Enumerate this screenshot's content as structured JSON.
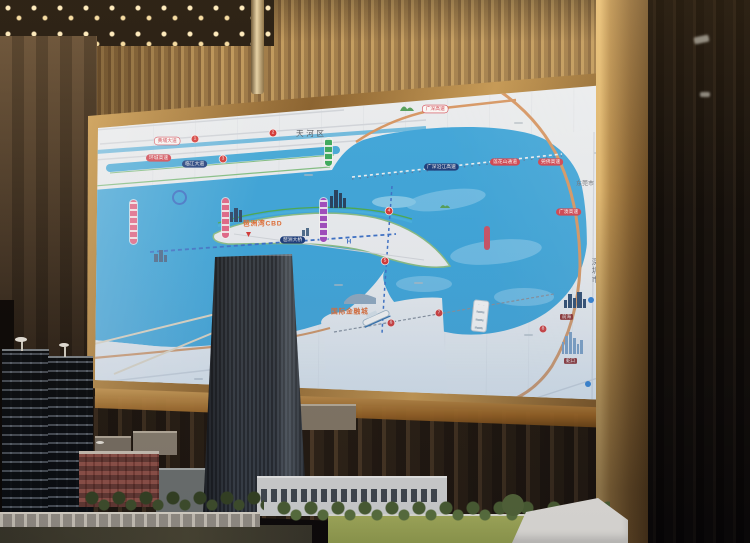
{
  "map": {
    "title_district": "天河区",
    "city_dongguan": "东莞市",
    "city_shenzhen": "深圳市",
    "cbd_label": "琶洲湾CBD",
    "financial_city_label": "国际金融城",
    "expressway_bay_pill": "广深沿江高速",
    "crossing_pill": "莲花山通道",
    "bridge_pill": "琶洲大桥",
    "road_pill_white_left": "黄埔大道",
    "road_pill_red_left": "环城高速",
    "road_pill_navy_left": "临江大道",
    "road_pill_white_top": "广深高速",
    "road_pill_red_right_1": "莞佛高速",
    "road_pill_red_right_2": "广澳高速",
    "road_pill_red_bottom": "南沙港快速",
    "sz_tag_1": "前海",
    "sz_tag_2": "蛇口",
    "hospital_marker": "H",
    "stations": [
      "1",
      "2",
      "3",
      "4",
      "5",
      "6",
      "7",
      "8"
    ],
    "icons": {
      "station_marker": "metro-station-dot",
      "boat": "ferry-boat-icon",
      "skyline": "city-skyline-icon",
      "hills": "green-hills-icon",
      "landmark_pin": "red-landmark-pin",
      "logo_ring": "blue-ring-logo"
    },
    "colors": {
      "water": "#42a9de",
      "screen_bg": "#eef3f8",
      "gold_frame": "#c79c58",
      "road_orange": "#d79a6a",
      "pill_red": "#cf4452",
      "pill_navy": "#1d3e7d",
      "metro_green": "#3fae62",
      "metro_purple": "#a04ec0",
      "metro_pink": "#e2688a",
      "orange_label": "#e0703a"
    }
  }
}
